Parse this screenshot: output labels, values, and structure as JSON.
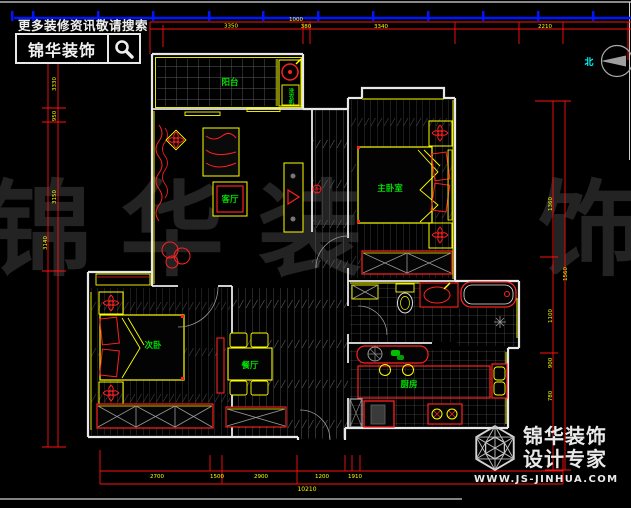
{
  "banner": {
    "slogan": "更多装修资讯敬请搜索",
    "brand": "锦华装饰"
  },
  "rooms": {
    "balcony": "阳台",
    "laundry": "洗衣机",
    "living": "客厅",
    "master_bedroom": "主卧室",
    "second_bedroom": "次卧",
    "dining": "餐厅",
    "kitchen": "厨房"
  },
  "compass": {
    "north": "北"
  },
  "footer": {
    "brand": "锦华装饰",
    "tagline": "设计专家",
    "website": "WWW.JS-JINHUA.COM"
  },
  "watermark": {
    "chars": [
      "锦",
      "华",
      "装",
      "饰"
    ]
  },
  "dims": {
    "top": [
      "3350",
      "1000",
      "380",
      "3340",
      "2210"
    ],
    "left": [
      "3330",
      "950",
      "3150",
      "3140"
    ],
    "right": [
      "1360",
      "1560",
      "1100",
      "900",
      "780"
    ],
    "bottom": [
      "2700",
      "1500",
      "2900",
      "1200",
      "1910"
    ],
    "bottom_total": "10210"
  },
  "colors": {
    "wall": "#e8e8e8",
    "accent_yellow": "#ffff00",
    "accent_red": "#ff2020",
    "label_green": "#00dd00",
    "dim_blue": "#0016ff",
    "watermark": "#232323",
    "north_cyan": "#00ffff"
  }
}
